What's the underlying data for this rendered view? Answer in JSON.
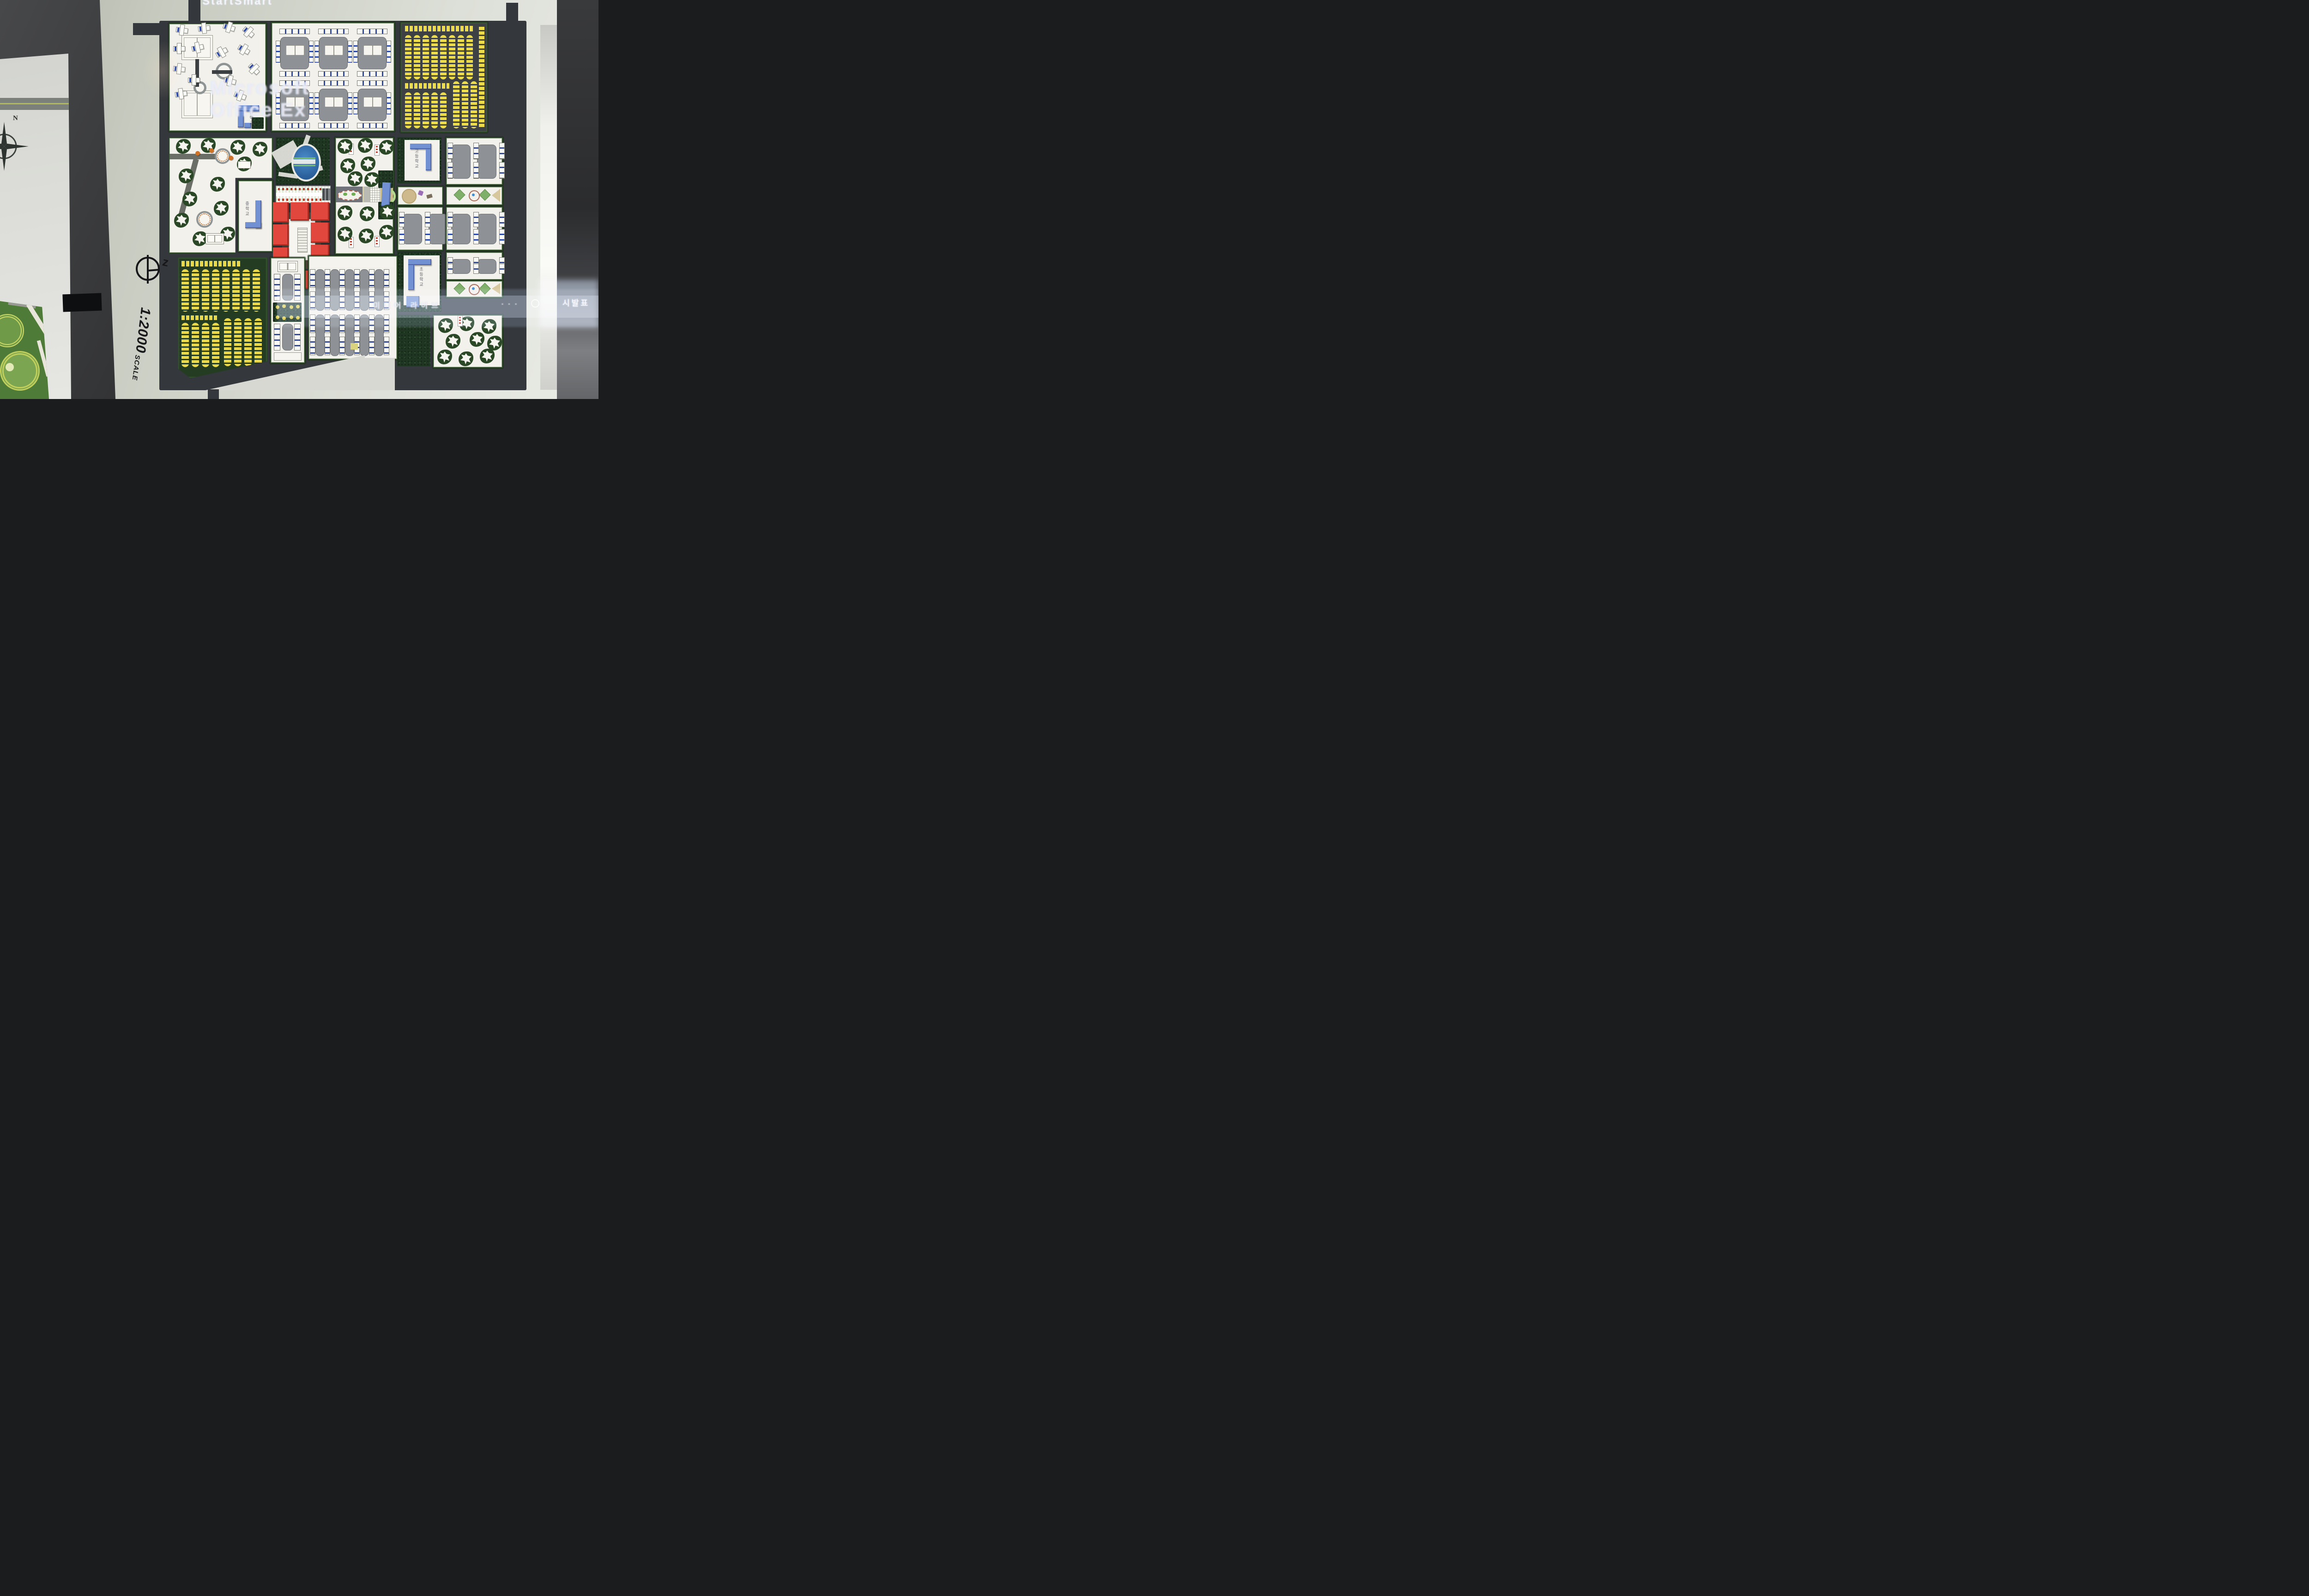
{
  "scene": {
    "kind": "photograph of an architectural urban master-plan scale model on presentation boards",
    "model_scale": "1:2000"
  },
  "overlays": {
    "projected_title": "StartSmart",
    "projected_line1": "Microsoft",
    "projected_line2": "Office Ex",
    "projected_band_text": "미디어 라이브",
    "projected_band_dots": "· · ·",
    "right_board_text": "시발표"
  },
  "annotations": {
    "scale_text": "1:2000",
    "scale_word": "SCALE",
    "north_symbol_letter": "z",
    "compass_label": "N"
  },
  "model_labels": {
    "block_a_school": "초등학교",
    "middle_school": "중학교",
    "high_school": "고등학교",
    "bottom_school": "초등학교"
  },
  "colors": {
    "board": "#d2d5cb",
    "road": "#34373b",
    "hedge": "#2c4a28",
    "forest": "#1f3622",
    "yellow_units": "#ecdc4b",
    "red_buildings": "#e2473d",
    "blue_buildings": "#7291d2",
    "blue_stripe": "#2e4aa8",
    "gray_yard": "#8e9296",
    "pond": "#2f6fb4",
    "tan_garden": "#cfc08f",
    "projection_band": "#bcd0f0"
  }
}
